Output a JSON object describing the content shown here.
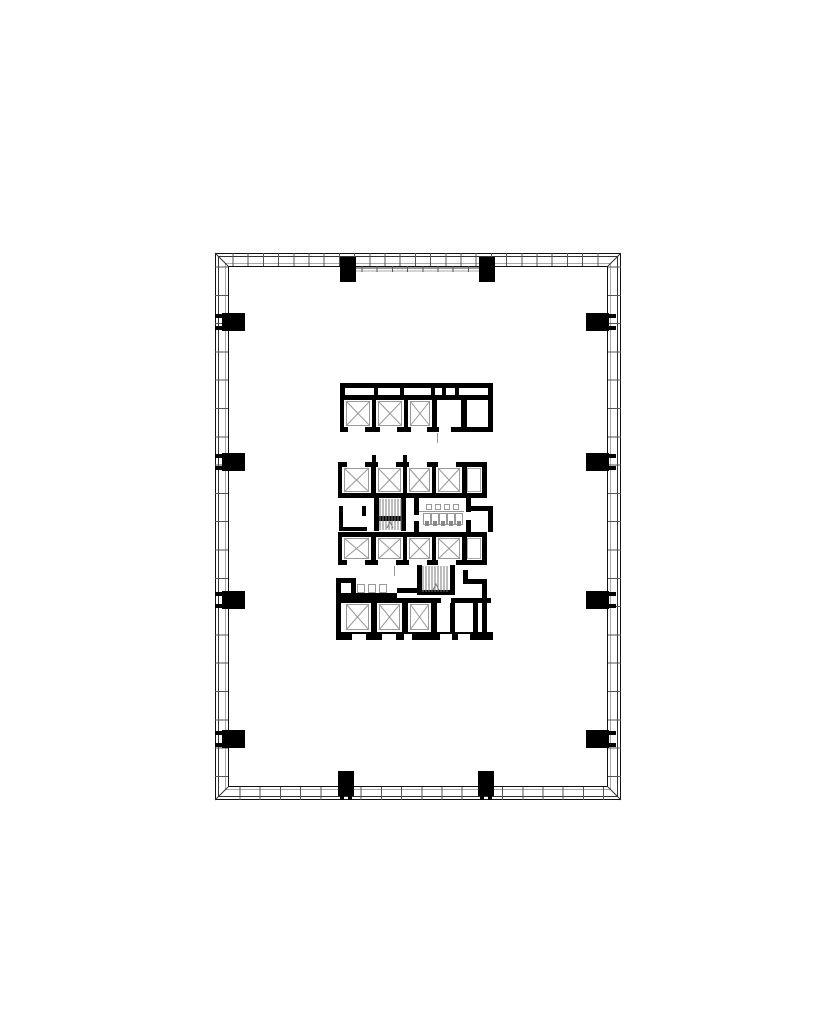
{
  "canvas": {
    "width": 828,
    "height": 1036,
    "background": "#ffffff"
  },
  "palette": {
    "wall": "#000000",
    "facade_dark": "#111111",
    "facade_mid": "#333333",
    "facade_light": "#aaaaaa",
    "tick": "#555555",
    "thin": "#999999",
    "hatch": "#7a7a7a",
    "fixture_mark": "#888888",
    "white": "#ffffff"
  },
  "facade": {
    "x": 215,
    "y": 253,
    "w": 406,
    "h": 547,
    "line_offsets": [
      0,
      3,
      10,
      13
    ],
    "line_colors": [
      "#111111",
      "#333333",
      "#aaaaaa",
      "#111111"
    ],
    "band": 13,
    "ticks": {
      "left": {
        "start": 267,
        "step": 28.3
      },
      "right": {
        "start": 267,
        "step": 28.3
      },
      "top": {
        "start": 233,
        "step": 15.2
      },
      "bottom": {
        "start": 240,
        "step": 20.2
      }
    },
    "top_inset_band": {
      "x1": 356,
      "x2": 479,
      "y1": 268,
      "y2": 271,
      "tick_step": 15.2
    }
  },
  "columns": {
    "left": {
      "x": 222,
      "w": 23,
      "h": 18,
      "ys": [
        313,
        453,
        591,
        730
      ],
      "tabs": {
        "x": 215,
        "w": 9,
        "h": 4,
        "dy": [
          1,
          13
        ]
      }
    },
    "right": {
      "x": 586,
      "w": 23,
      "h": 18,
      "ys": [
        313,
        453,
        591,
        730
      ],
      "tabs": {
        "x": 607,
        "w": 9,
        "h": 4,
        "dy": [
          1,
          13
        ]
      }
    },
    "top": {
      "y": 257,
      "w": 16,
      "h": 25,
      "xs": [
        340,
        479
      ]
    },
    "bottom": {
      "y": 771,
      "w": 16,
      "h": 25,
      "xs": [
        338,
        478
      ],
      "legs": {
        "y": 796,
        "w": 4,
        "h": 4,
        "dx": [
          2,
          10
        ]
      }
    }
  },
  "core_walls": [
    [
      340,
      383,
      153,
      5
    ],
    [
      340,
      383,
      5,
      49
    ],
    [
      488,
      383,
      5,
      49
    ],
    [
      340,
      427,
      153,
      5
    ],
    [
      345,
      395,
      143,
      5
    ],
    [
      374,
      388,
      4,
      7
    ],
    [
      400,
      388,
      4,
      7
    ],
    [
      431,
      388,
      4,
      7
    ],
    [
      442,
      388,
      4,
      7
    ],
    [
      455,
      388,
      4,
      7
    ],
    [
      371,
      400,
      6,
      27
    ],
    [
      403,
      400,
      6,
      27
    ],
    [
      431,
      400,
      6,
      27
    ],
    [
      461,
      400,
      6,
      27
    ],
    [
      338,
      462,
      149,
      5
    ],
    [
      338,
      462,
      5,
      36
    ],
    [
      482,
      462,
      5,
      36
    ],
    [
      338,
      493,
      149,
      5
    ],
    [
      371,
      467,
      6,
      26
    ],
    [
      402,
      467,
      6,
      26
    ],
    [
      431,
      467,
      6,
      26
    ],
    [
      461,
      467,
      6,
      26
    ],
    [
      372,
      455,
      4,
      7
    ],
    [
      403,
      455,
      4,
      7
    ],
    [
      339,
      506,
      4,
      25
    ],
    [
      339,
      527,
      28,
      4
    ],
    [
      362,
      506,
      4,
      10
    ],
    [
      374,
      498,
      5,
      33
    ],
    [
      401,
      498,
      5,
      33
    ],
    [
      379,
      516,
      22,
      5
    ],
    [
      414,
      498,
      5,
      17
    ],
    [
      414,
      521,
      5,
      11
    ],
    [
      466,
      498,
      5,
      14
    ],
    [
      466,
      520,
      5,
      12
    ],
    [
      470,
      506,
      23,
      5
    ],
    [
      488,
      511,
      5,
      21
    ],
    [
      338,
      532,
      149,
      5
    ],
    [
      338,
      532,
      5,
      33
    ],
    [
      482,
      532,
      5,
      33
    ],
    [
      338,
      560,
      149,
      5
    ],
    [
      371,
      537,
      6,
      23
    ],
    [
      402,
      537,
      6,
      23
    ],
    [
      431,
      537,
      6,
      23
    ],
    [
      461,
      537,
      6,
      23
    ],
    [
      417,
      565,
      5,
      28
    ],
    [
      450,
      565,
      5,
      28
    ],
    [
      417,
      590,
      38,
      5
    ],
    [
      336,
      578,
      5,
      62
    ],
    [
      336,
      578,
      20,
      5
    ],
    [
      351,
      578,
      5,
      22
    ],
    [
      463,
      570,
      5,
      14
    ],
    [
      463,
      579,
      24,
      5
    ],
    [
      482,
      579,
      5,
      61
    ],
    [
      341,
      593,
      56,
      5
    ],
    [
      397,
      588,
      23,
      5
    ],
    [
      336,
      598,
      155,
      5
    ],
    [
      371,
      603,
      6,
      29
    ],
    [
      402,
      603,
      6,
      29
    ],
    [
      431,
      603,
      6,
      29
    ],
    [
      450,
      603,
      5,
      29
    ],
    [
      473,
      603,
      5,
      29
    ],
    [
      336,
      632,
      157,
      8
    ]
  ],
  "door_openings": [
    [
      348,
      427,
      17,
      5
    ],
    [
      380,
      427,
      17,
      5
    ],
    [
      411,
      427,
      16,
      5
    ],
    [
      439,
      427,
      12,
      5
    ],
    [
      347,
      462,
      18,
      5
    ],
    [
      378,
      462,
      18,
      5
    ],
    [
      409,
      462,
      18,
      5
    ],
    [
      438,
      462,
      18,
      5
    ],
    [
      347,
      560,
      18,
      5
    ],
    [
      378,
      560,
      18,
      5
    ],
    [
      409,
      560,
      18,
      5
    ],
    [
      438,
      560,
      18,
      5
    ],
    [
      441,
      598,
      10,
      5
    ],
    [
      352,
      634,
      14,
      6
    ],
    [
      382,
      634,
      14,
      6
    ],
    [
      404,
      634,
      8,
      6
    ],
    [
      440,
      634,
      12,
      6
    ],
    [
      458,
      634,
      12,
      6
    ]
  ],
  "elevator_shafts": [
    [
      346,
      401,
      24,
      25
    ],
    [
      378,
      401,
      24,
      25
    ],
    [
      410,
      401,
      20,
      25
    ],
    [
      344,
      468,
      25,
      24
    ],
    [
      378,
      468,
      23,
      24
    ],
    [
      409,
      468,
      21,
      24
    ],
    [
      438,
      468,
      22,
      24
    ],
    [
      344,
      538,
      25,
      21
    ],
    [
      378,
      538,
      23,
      21
    ],
    [
      409,
      538,
      21,
      21
    ],
    [
      438,
      538,
      22,
      21
    ],
    [
      346,
      604,
      23,
      26
    ],
    [
      379,
      604,
      21,
      26
    ],
    [
      410,
      604,
      19,
      26
    ]
  ],
  "plain_rooms": [
    [
      467,
      468,
      14,
      24
    ],
    [
      467,
      538,
      14,
      21
    ]
  ],
  "stairs": [
    {
      "x": 380,
      "y": 499,
      "w": 21,
      "h": 31,
      "step": 3
    },
    {
      "x": 423,
      "y": 566,
      "w": 26,
      "h": 26,
      "step": 3
    }
  ],
  "fixtures_outline": [
    [
      423,
      513,
      8,
      12
    ],
    [
      431,
      513,
      8,
      12
    ],
    [
      439,
      513,
      8,
      12
    ],
    [
      447,
      513,
      8,
      12
    ],
    [
      455,
      513,
      8,
      12
    ],
    [
      426,
      504,
      6,
      6
    ],
    [
      435,
      504,
      6,
      6
    ],
    [
      444,
      504,
      6,
      6
    ],
    [
      453,
      504,
      6,
      6
    ],
    [
      357,
      584,
      8,
      9
    ],
    [
      368,
      584,
      8,
      9
    ],
    [
      379,
      584,
      8,
      9
    ]
  ],
  "fixture_marks": [
    [
      425,
      521,
      4,
      5
    ],
    [
      433,
      521,
      4,
      5
    ],
    [
      441,
      521,
      4,
      5
    ],
    [
      449,
      521,
      4,
      5
    ],
    [
      457,
      521,
      4,
      5
    ]
  ],
  "detail_lines": [
    [
      419,
      511,
      45,
      1
    ],
    [
      437,
      433,
      1,
      10
    ],
    [
      394,
      566,
      1,
      10
    ]
  ],
  "stair_direction_marks": [
    [
      387,
      528,
      390,
      522,
      393,
      528
    ],
    [
      433,
      590,
      436,
      584,
      439,
      590
    ]
  ],
  "corner_miters": [
    [
      215,
      253,
      228,
      266
    ],
    [
      621,
      253,
      608,
      266
    ],
    [
      215,
      800,
      228,
      787
    ],
    [
      621,
      800,
      608,
      787
    ]
  ]
}
